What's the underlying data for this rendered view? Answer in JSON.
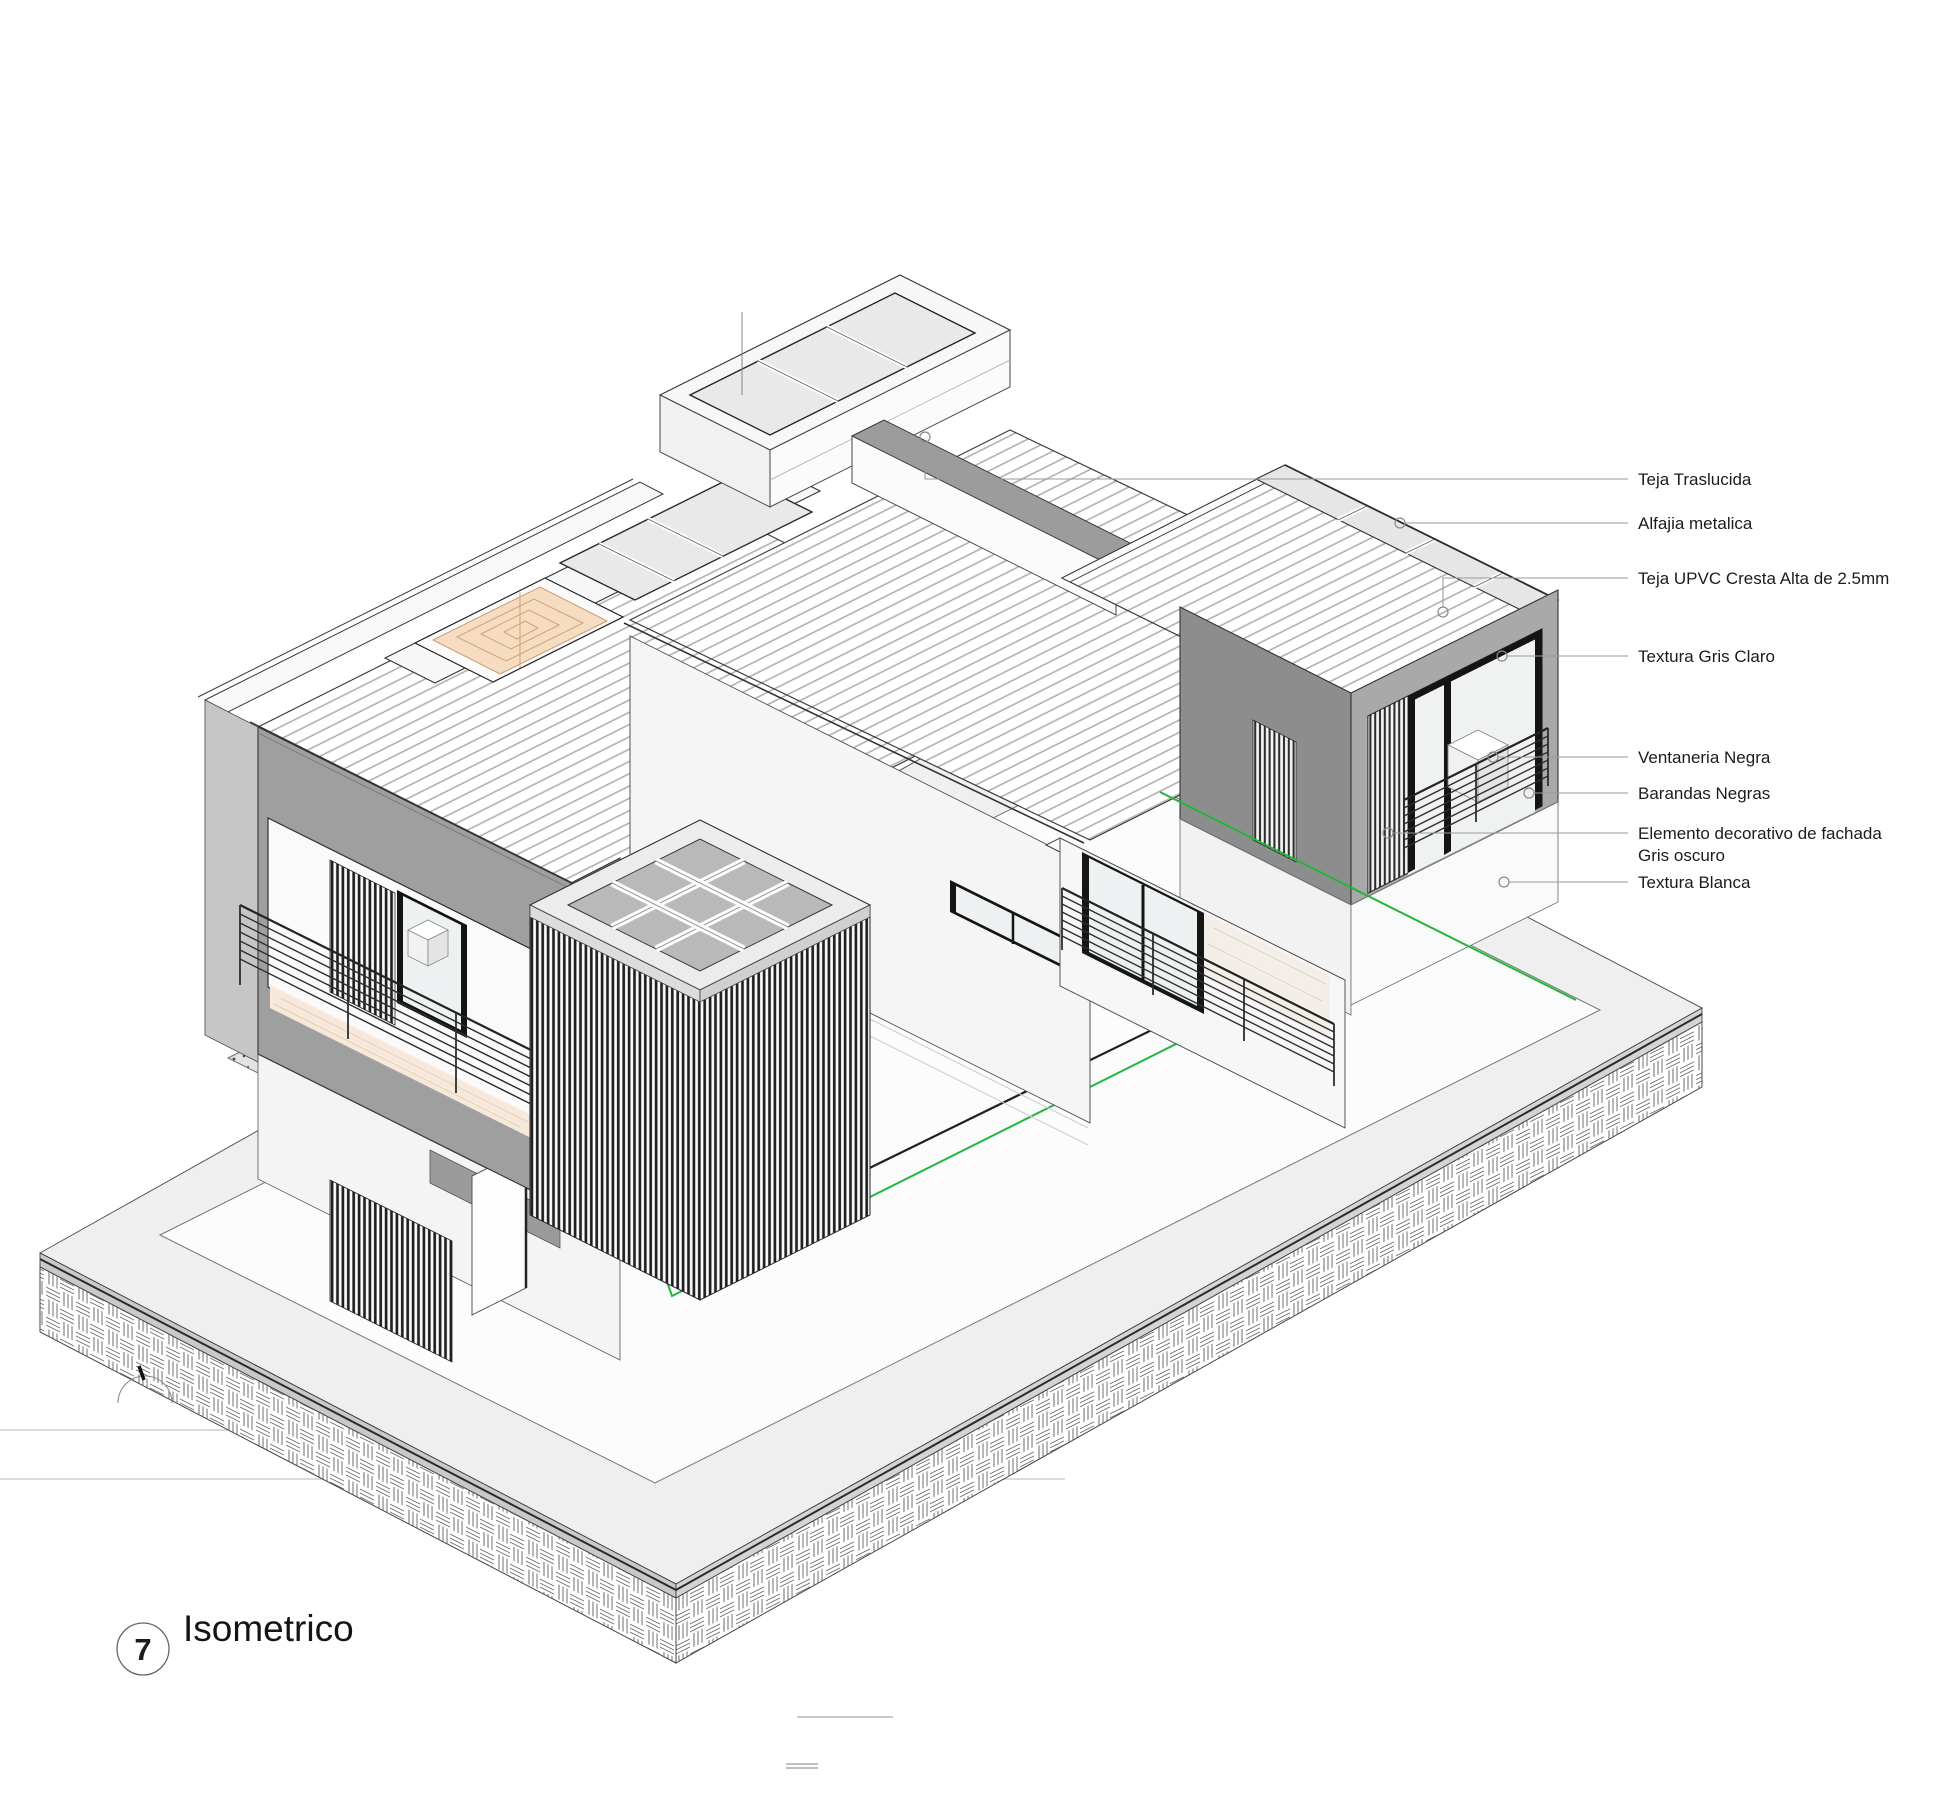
{
  "drawing": {
    "title": "Isometrico",
    "view_number": "7",
    "type": "isometric-architectural-view"
  },
  "annotations": [
    {
      "label": "Teja Traslucida"
    },
    {
      "label": "Alfajia metalica"
    },
    {
      "label": "Teja UPVC Cresta Alta de 2.5mm"
    },
    {
      "label": "Textura Gris Claro"
    },
    {
      "label": "Ventaneria Negra"
    },
    {
      "label": "Barandas Negras"
    },
    {
      "label": "Elemento decorativo de fachada",
      "label_line2": "Gris oscuro"
    },
    {
      "label": "Textura Blanca"
    }
  ],
  "colors": {
    "accent_green": "#22b43c",
    "skylight_tan": "#f6dcc1",
    "fascia_gray_light": "#a9a9a9",
    "fascia_gray_dark": "#8d8d8d",
    "roof_stripe": "#ababab",
    "louver_dark": "#202020",
    "platform_gray": "#efefef",
    "translucent_panel": "#e6e6e6",
    "leader_gray": "#9a9a9a"
  }
}
